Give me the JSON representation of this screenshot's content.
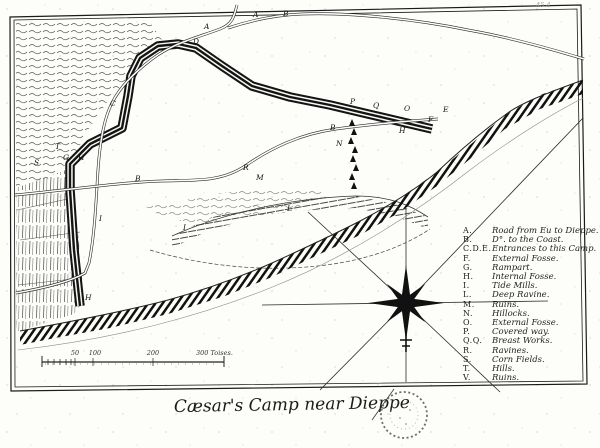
{
  "page": {
    "title": "Cæsar's Camp near Dieppe",
    "corner_annotation": "45.4"
  },
  "legend": {
    "items": [
      {
        "letter": "A.",
        "label": "Road from Eu to Dieppe."
      },
      {
        "letter": "B.",
        "label": "D°. to the Coast."
      },
      {
        "letter": "C.D.E.",
        "label": "Entrances to this Camp."
      },
      {
        "letter": "F.",
        "label": "External Fosse."
      },
      {
        "letter": "G.",
        "label": "Rampart."
      },
      {
        "letter": "H.",
        "label": "Internal Fosse."
      },
      {
        "letter": "I.",
        "label": "Tide Mills."
      },
      {
        "letter": "L.",
        "label": "Deep Ravine."
      },
      {
        "letter": "M.",
        "label": "Ruins."
      },
      {
        "letter": "N.",
        "label": "Hillocks."
      },
      {
        "letter": "O.",
        "label": "External Fosse."
      },
      {
        "letter": "P.",
        "label": "Covered way."
      },
      {
        "letter": "Q.Q.",
        "label": "Breast Works."
      },
      {
        "letter": "R.",
        "label": "Ravines."
      },
      {
        "letter": "S.",
        "label": "Corn Fields."
      },
      {
        "letter": "T.",
        "label": "Hills."
      },
      {
        "letter": "V.",
        "label": "Ruins."
      }
    ]
  },
  "scale_bar": {
    "labels": [
      "50",
      "100",
      "200",
      "300 Toises."
    ],
    "unit": "Toises"
  },
  "map_labels": [
    "A",
    "A",
    "B",
    "B",
    "B",
    "C",
    "D",
    "E",
    "F",
    "G",
    "H",
    "P",
    "Q",
    "O",
    "H",
    "N",
    "I",
    "I",
    "H",
    "S",
    "T",
    "M",
    "R",
    "L"
  ],
  "icons": {
    "compass": "eight-point-star-icon",
    "stamp": "round-ink-stamp-icon",
    "hillocks": "triangle-hillock-icons"
  },
  "colors": {
    "ink": "#1a1a1a",
    "paper": "#fdfdfa"
  }
}
